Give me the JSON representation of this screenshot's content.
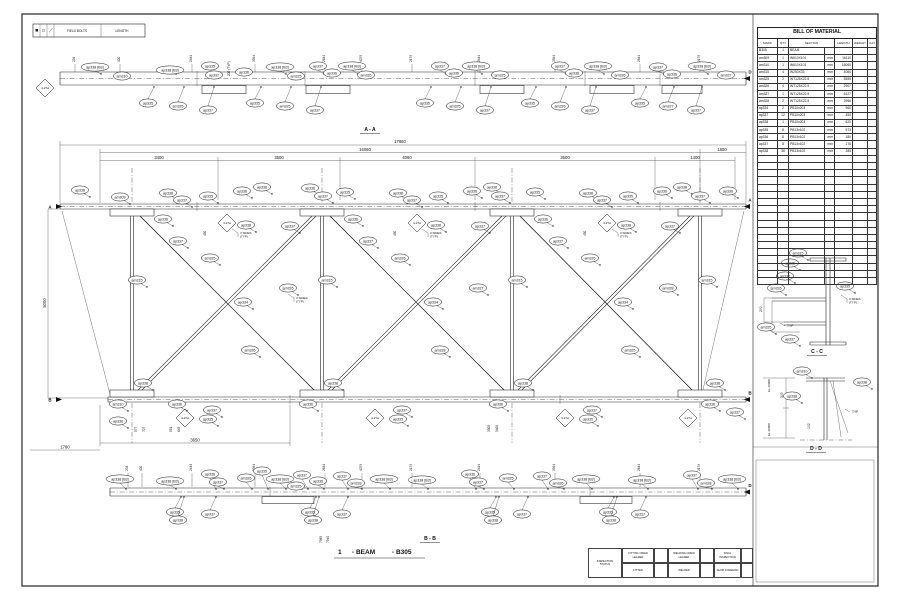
{
  "legend": {
    "field_bolts": "FIELD BOLTS",
    "length": "LENGTH"
  },
  "bom": {
    "title": "BILL OF MATERIAL",
    "headers": [
      "MARK",
      "QTY",
      "SECTION",
      "LENGTH",
      "WEIGHT",
      "CAT"
    ],
    "rows": [
      {
        "mark": "B305",
        "qty": "1",
        "section": "BEAM",
        "unit": "",
        "length": ""
      },
      {
        "mark": "am309",
        "qty": "1",
        "section": "W610X101",
        "unit": "mm",
        "length": "16110"
      },
      {
        "mark": "am310",
        "qty": "1",
        "section": "W610X101",
        "unit": "mm",
        "length": "16060"
      },
      {
        "mark": "am315",
        "qty": "4",
        "section": "W250X33",
        "unit": "mm",
        "length": "4060"
      },
      {
        "mark": "am325",
        "qty": "2",
        "section": "WT125X22.5",
        "unit": "mm",
        "length": "5599"
      },
      {
        "mark": "am326",
        "qty": "4",
        "section": "WT125X22.5",
        "unit": "mm",
        "length": "2907"
      },
      {
        "mark": "am327",
        "qty": "1",
        "section": "WT125X22.5",
        "unit": "mm",
        "length": "6127"
      },
      {
        "mark": "am328",
        "qty": "2",
        "section": "WT125X22.5",
        "unit": "mm",
        "length": "2956"
      },
      {
        "mark": "ap334",
        "qty": "2",
        "section": "PB10x203",
        "unit": "mm",
        "length": "960"
      },
      {
        "mark": "ap337",
        "qty": "12",
        "section": "PB10x203",
        "unit": "mm",
        "length": "450"
      },
      {
        "mark": "ap338",
        "qty": "1",
        "section": "PB10x203",
        "unit": "mm",
        "length": "620"
      },
      {
        "mark": "ap335",
        "qty": "8",
        "section": "PB13x102",
        "unit": "mm",
        "length": "573"
      },
      {
        "mark": "ap336",
        "qty": "8",
        "section": "PB13x102",
        "unit": "mm",
        "length": "180"
      },
      {
        "mark": "ap337",
        "qty": "8",
        "section": "PB13x102",
        "unit": "mm",
        "length": "178"
      },
      {
        "mark": "ap338",
        "qty": "38",
        "section": "PB13x102",
        "unit": "mm",
        "length": "285"
      }
    ],
    "empty_rows": 18
  },
  "views": {
    "aa": "A - A",
    "bb": "B - B",
    "cc": "C - C",
    "dd": "D - D"
  },
  "drawing_title": {
    "number": "1",
    "name": "- BEAM",
    "mark": "- B305"
  },
  "markers": {
    "a": "A",
    "b": "B",
    "d": "D"
  },
  "dims": {
    "overall": "17860",
    "inner": "16060",
    "segments": [
      "3400",
      "3500",
      "4060",
      "3500",
      "1400"
    ],
    "right_end": "1800",
    "height": "5000",
    "bottom_left": "1780",
    "bottom_splice": "3650",
    "typ200": "200 (TYP)",
    "cc_200": "200",
    "dd_300": "300",
    "dd_102": "102",
    "el_top": "EL.10008",
    "el_bottom": "EL.20008"
  },
  "tick_dims": {
    "aa": [
      "234",
      "420",
      "2444",
      "3394",
      "2644",
      "4079",
      "2179",
      "2444",
      "3394",
      "2644",
      "2179"
    ],
    "bb": [
      "234",
      "420",
      "2444",
      "3394",
      "2644",
      "4079",
      "2179",
      "2444",
      "3394",
      "2644",
      "2179"
    ],
    "elev_bottom": [
      "577",
      "707",
      "551",
      "643",
      "3305",
      "3400"
    ],
    "elev_450": [
      "450",
      "450",
      "450"
    ],
    "bb_left": [
      "7985",
      "7940"
    ]
  },
  "notes": {
    "bolts": "4-27ø",
    "weld_3sides": "3 SIDES",
    "typ": "(TYP)",
    "typ_short": "TYP"
  },
  "callouts": {
    "aa_top": [
      "ap338 [B3]",
      "am310",
      "ap338 [B3]",
      "ap335",
      "ap337",
      "ap336",
      "ap338 [B3]",
      "am325",
      "ap337",
      "ap336",
      "ap338 [B3]",
      "am326",
      "ap337",
      "ap336",
      "ap338 [B3]",
      "am325",
      "ap337",
      "ap336",
      "ap338 [B3]",
      "am326",
      "ap337",
      "ap336",
      "ap338 [B3]",
      "am327"
    ],
    "aa_bottom": [
      "ap335",
      "am325",
      "ap337",
      "ap335",
      "am325",
      "ap337",
      "ap335",
      "am325",
      "ap337",
      "ap335",
      "am326",
      "ap337",
      "ap335",
      "am327",
      "ap337"
    ],
    "elev": [
      "ap336",
      "am309",
      "ap338",
      "ap337",
      "ap335",
      "ap336",
      "ap338",
      "ap336",
      "ap337",
      "ap335",
      "ap338",
      "ap337",
      "ap335",
      "ap336",
      "ap338",
      "ap337",
      "ap335",
      "ap338",
      "ap337",
      "ap335",
      "ap336",
      "ap338",
      "ap337",
      "ap336",
      "ap336",
      "ap337",
      "ap338",
      "ap337",
      "am325",
      "am326",
      "ap334",
      "ap336",
      "ap337",
      "ap338",
      "ap337",
      "am326",
      "am327",
      "ap334",
      "ap336",
      "ap337",
      "ap338",
      "ap337",
      "am326",
      "am328",
      "ap334",
      "am326",
      "am328",
      "am325",
      "am315",
      "am315",
      "am315",
      "am315",
      "ap338",
      "am310",
      "ap338",
      "ap336",
      "ap337",
      "ap335",
      "ap338",
      "ap336",
      "ap337",
      "ap335",
      "ap338",
      "ap336",
      "ap337",
      "ap335",
      "ap338",
      "ap336",
      "ap337"
    ],
    "bb_top": [
      "ap338 [B3]",
      "ap338 [B3]",
      "ap336",
      "ap337",
      "am326",
      "ap335",
      "ap338 [B3]",
      "ap337",
      "ap336",
      "am325",
      "ap337",
      "am328",
      "ap338 [B3]",
      "ap338 [B3]",
      "ap336",
      "ap337",
      "am325",
      "ap337",
      "am326",
      "ap338 [B3]",
      "ap338 [B3]",
      "ap337",
      "am328",
      "ap338 [B3]"
    ],
    "bb_bottom": [
      "ap335",
      "ap338",
      "ap337",
      "ap335",
      "ap338",
      "ap337",
      "ap335",
      "ap338",
      "ap337",
      "ap335",
      "ap338",
      "ap337"
    ],
    "cc": [
      "am315",
      "ap336",
      "ap337",
      "am326",
      "ap335",
      "am325",
      "ap337"
    ],
    "dd": [
      "am310",
      "ap338",
      "ap338"
    ]
  },
  "title_block": {
    "inspection": "INSPECTION",
    "status": "STATUS",
    "fitting_crew": "FITTING CREW",
    "leader": "LEADER",
    "fitter": "FITTER",
    "welding_crew": "WELDING CREW",
    "welder": "WELDER",
    "final_inspection": "FINAL INSPECTION",
    "shop_foreman": "SHOP FOREMAN"
  }
}
